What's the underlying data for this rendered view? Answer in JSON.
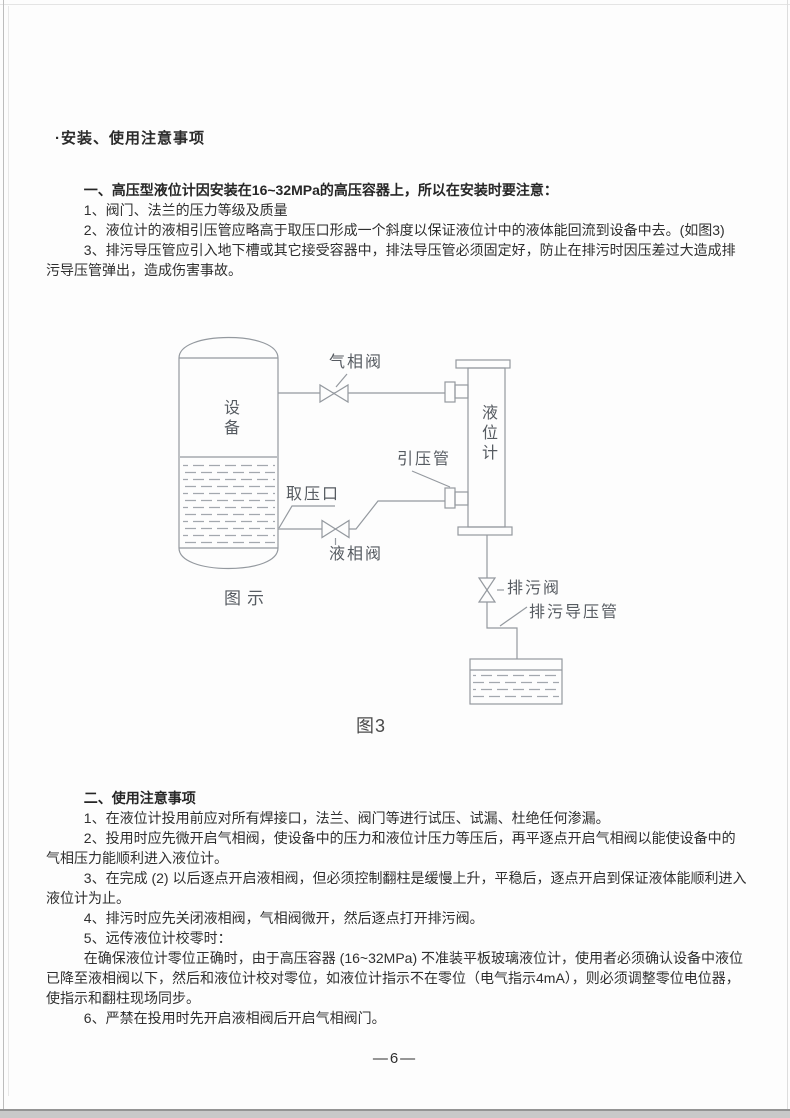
{
  "document": {
    "title": "·安装、使用注意事项",
    "section1": {
      "intro": "一、高压型液位计因安装在16~32MPa的高压容器上，所以在安装时要注意：",
      "items": [
        "1、阀门、法兰的压力等级及质量",
        "2、液位计的液相引压管应略高于取压口形成一个斜度以保证液位计中的液体能回流到设备中去。(如图3)",
        "3、排污导压管应引入地下槽或其它接受容器中，排法导压管必须固定好，防止在排污时因压差过大造成排污导压管弹出，造成伤害事故。"
      ]
    },
    "figure": {
      "caption": "图3",
      "inner_caption": "图示",
      "labels": {
        "vessel": "设备",
        "gas_phase_valve": "气相阀",
        "level_gauge": "液位计",
        "impulse_pipe": "引压管",
        "pressure_tap": "取压口",
        "liquid_phase_valve": "液相阀",
        "drain_valve": "排污阀",
        "drain_impulse_pipe": "排污导压管"
      }
    },
    "section2": {
      "heading": "二、使用注意事项",
      "items": [
        "1、在液位计投用前应对所有焊接口，法兰、阀门等进行试压、试漏、杜绝任何渗漏。",
        "2、投用时应先微开启气相阀，使设备中的压力和液位计压力等压后，再平逐点开启气相阀以能使设备中的气相压力能顺利进入液位计。",
        "3、在完成 (2) 以后逐点开启液相阀，但必须控制翻柱是缓慢上升，平稳后，逐点开启到保证液体能顺利进入液位计为止。",
        "4、排污时应先关闭液相阀，气相阀微开，然后逐点打开排污阀。",
        "5、远传液位计校零时：",
        "6、严禁在投用时先开启液相阀后开启气相阀门。"
      ],
      "note": "在确保液位计零位正确时，由于高压容器 (16~32MPa) 不准装平板玻璃液位计，使用者必须确认设备中液位已降至液相阀以下，然后和液位计校对零位，如液位计指示不在零位（电气指示4mA），则必须调整零位电位器，使指示和翻柱现场同步。"
    },
    "page_number": "—6—"
  }
}
